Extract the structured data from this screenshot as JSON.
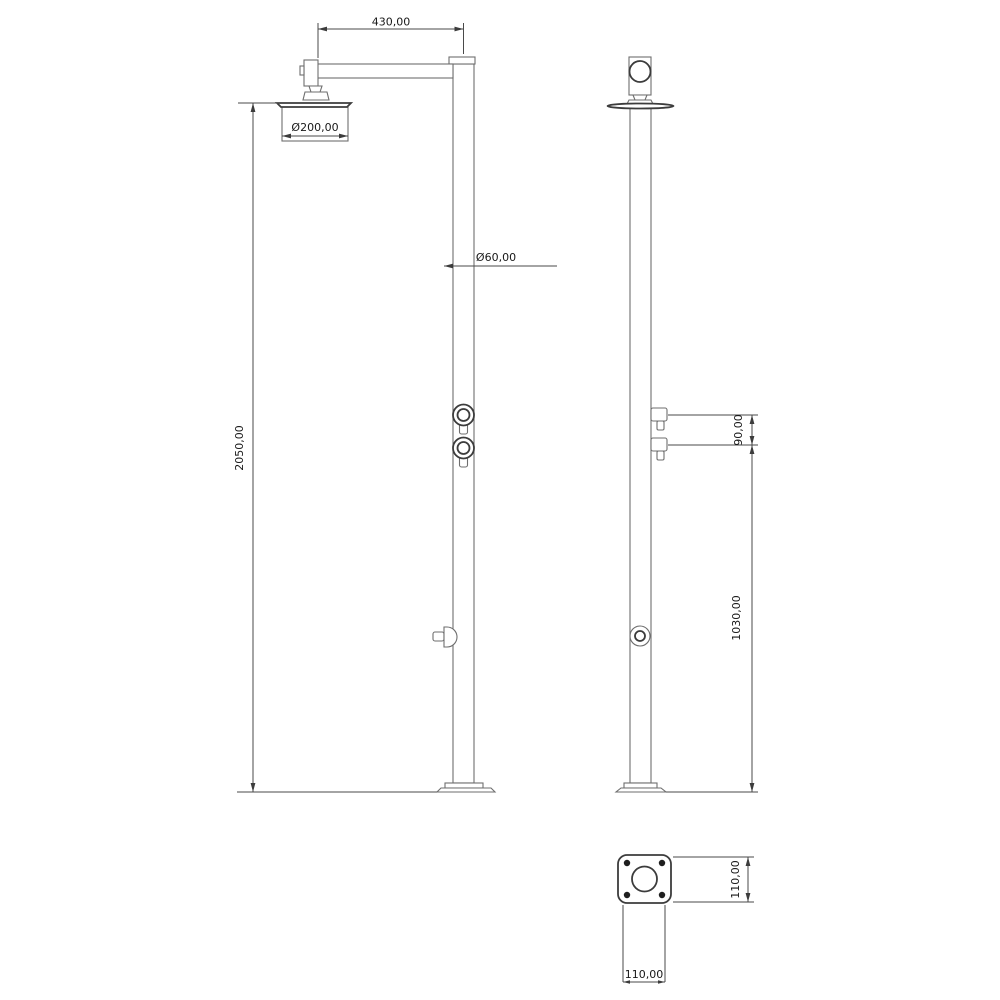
{
  "dimensions": {
    "arm_length": "430,00",
    "head_diameter": "Ø200,00",
    "pipe_diameter": "Ø60,00",
    "total_height": "2050,00",
    "handle_spacing": "90,00",
    "outlet_height": "1030,00",
    "base_plate_side": "110,00",
    "base_plate_front": "110,00"
  },
  "colors": {
    "geometry_line": "#6e6e6e",
    "detail_line": "#3c3c3c",
    "dimension_line": "#4a4a4a",
    "text": "#191919",
    "background": "#ffffff"
  }
}
